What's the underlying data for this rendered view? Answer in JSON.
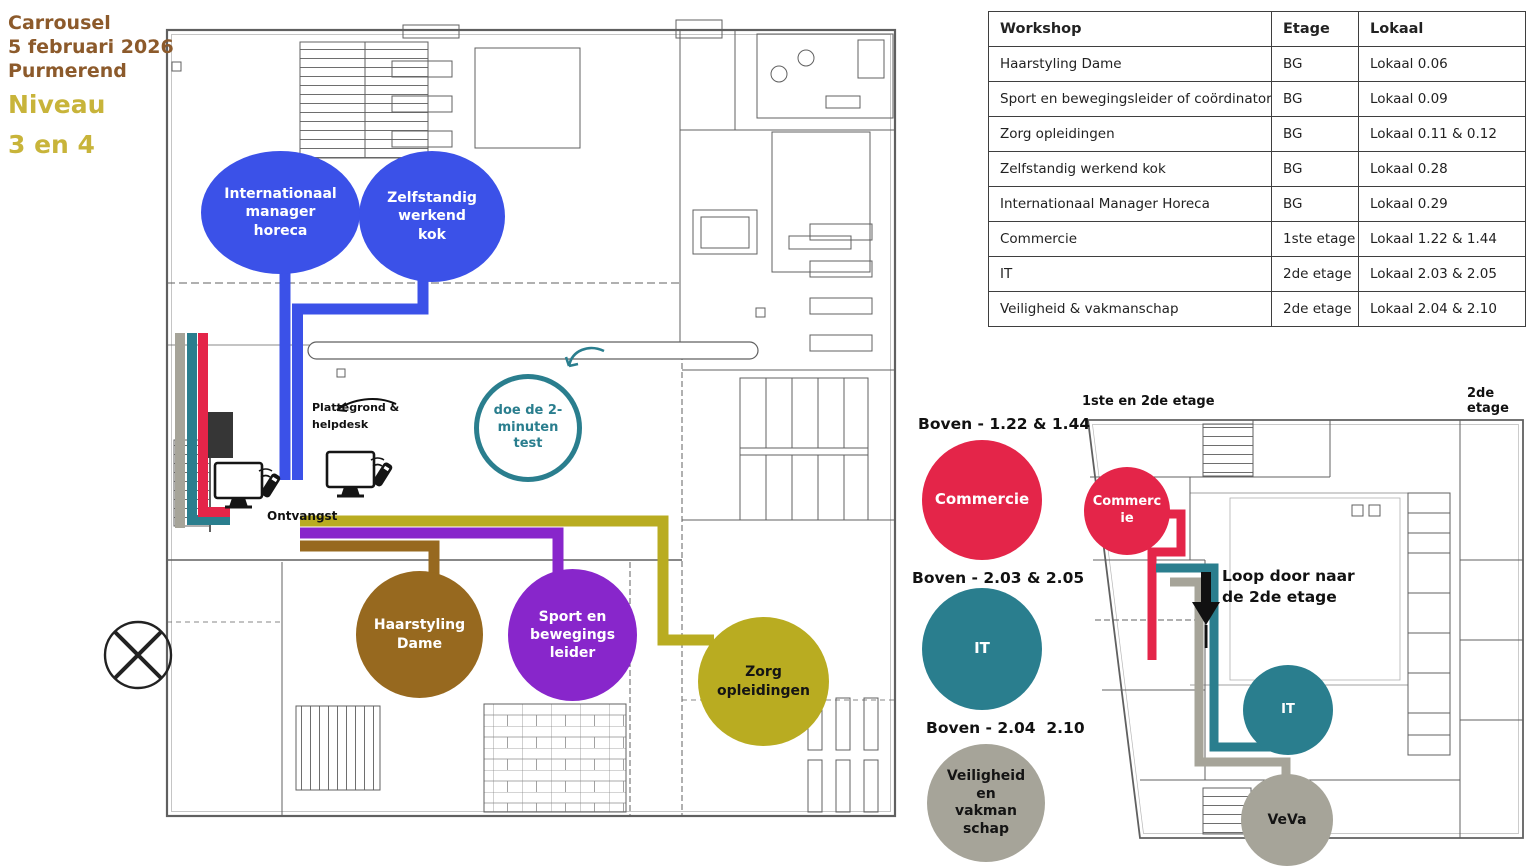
{
  "title": {
    "line1": "Carrousel",
    "line2": "5 februari 2026",
    "line3": "Purmerend",
    "line4": "Niveau",
    "line5": "3 en 4"
  },
  "table": {
    "headers": {
      "workshop": "Workshop",
      "etage": "Etage",
      "lokaal": "Lokaal"
    },
    "rows": [
      {
        "workshop": "Haarstyling Dame",
        "etage": "BG",
        "lokaal": "Lokaal 0.06"
      },
      {
        "workshop": "Sport en bewegingsleider of coördinator",
        "etage": "BG",
        "lokaal": "Lokaal 0.09"
      },
      {
        "workshop": "Zorg opleidingen",
        "etage": "BG",
        "lokaal": "Lokaal 0.11 & 0.12"
      },
      {
        "workshop": "Zelfstandig werkend kok",
        "etage": "BG",
        "lokaal": "Lokaal 0.28"
      },
      {
        "workshop": "Internationaal Manager Horeca",
        "etage": "BG",
        "lokaal": "Lokaal 0.29"
      },
      {
        "workshop": "Commercie",
        "etage": "1ste etage",
        "lokaal": "Lokaal 1.22 & 1.44"
      },
      {
        "workshop": "IT",
        "etage": "2de etage",
        "lokaal": "Lokaal 2.03 & 2.05"
      },
      {
        "workshop": "Veiligheid & vakmanschap",
        "etage": "2de etage",
        "lokaal": "Lokaal 2.04 & 2.10"
      }
    ]
  },
  "ground_floor": {
    "bubbles": {
      "internationaal": "Internationaal\nmanager\nhoreca",
      "kok": "Zelfstandig\nwerkend\nkok",
      "haarstyling": "Haarstyling\nDame",
      "sport": "Sport en\nbewegings\nleider",
      "zorg": "Zorg\nopleidingen",
      "test": "doe de 2-\nminuten\ntest"
    },
    "labels": {
      "plattegrond": "Plattegrond &\nhelpdesk",
      "ontvangst": "Ontvangst"
    }
  },
  "legend": {
    "commercie_title": "Boven - 1.22 & 1.44",
    "commercie": "Commercie",
    "it_title": "Boven - 2.03 & 2.05",
    "it": "IT",
    "veva_title": "Boven - 2.04  2.10",
    "veva": "Veiligheid\nen\nvakman\nschap"
  },
  "upper_floors": {
    "label_left": "1ste en 2de etage",
    "label_right": "2de etage",
    "commercie": "Commerc\nie",
    "it": "IT",
    "veva": "VeVa",
    "note": "Loop door naar\nde 2de etage"
  },
  "colors": {
    "blue": "#3B51E8",
    "red": "#E42549",
    "teal": "#2A7E8E",
    "yellow": "#B9AC21",
    "purple": "#8826CB",
    "brown": "#97691F",
    "gray": "#A6A499",
    "title_brown": "#8C5A2B",
    "title_yellow": "#C8B43A"
  }
}
